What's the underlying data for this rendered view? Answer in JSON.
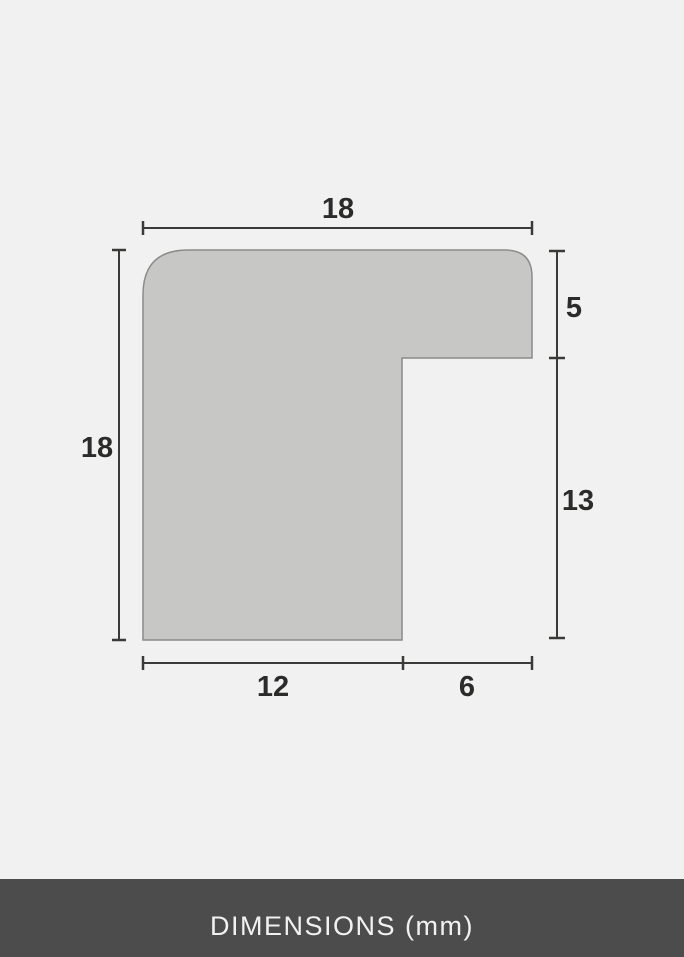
{
  "diagram": {
    "type": "frame-profile-cross-section",
    "unit": "mm",
    "dimensions": {
      "top_width": "18",
      "left_height": "18",
      "right_upper": "5",
      "right_lower": "13",
      "bottom_inner": "12",
      "bottom_outer": "6"
    },
    "colors": {
      "background": "#f1f1f1",
      "shape_fill": "#c7c7c6",
      "shape_stroke": "#8b8b8a",
      "dimension_line": "#3a3a39",
      "label_text": "#2b2b2a"
    }
  },
  "footer": {
    "label": "DIMENSIONS (mm)",
    "colors": {
      "background": "#4c4c4d",
      "text": "#f1f1f1"
    }
  }
}
